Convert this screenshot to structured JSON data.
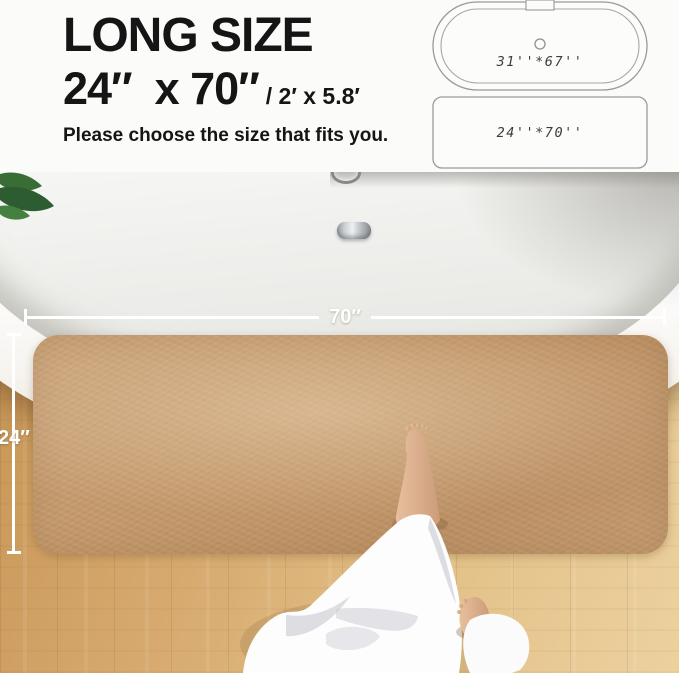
{
  "header": {
    "title": "LONG SIZE",
    "size_primary": "24″  x 70″",
    "size_secondary": "/ 2′ x 5.8′",
    "subtitle": "Please choose the size that fits you."
  },
  "size_diagrams": {
    "tub_dimensions": "31''*67''",
    "mat_dimensions": "24''*70''"
  },
  "photo_overlay": {
    "mat_width_label": "70″",
    "mat_height_label": "24″"
  },
  "colors": {
    "heading_text": "#151515",
    "mat": "#c29768",
    "floor": "#d9ae74",
    "dimension_line": "#ffffff",
    "diagram_stroke": "#9a9a9a",
    "leaf_green": "#35682f",
    "skin": "#d9ac8a",
    "robe_white": "#fdfdfe"
  }
}
